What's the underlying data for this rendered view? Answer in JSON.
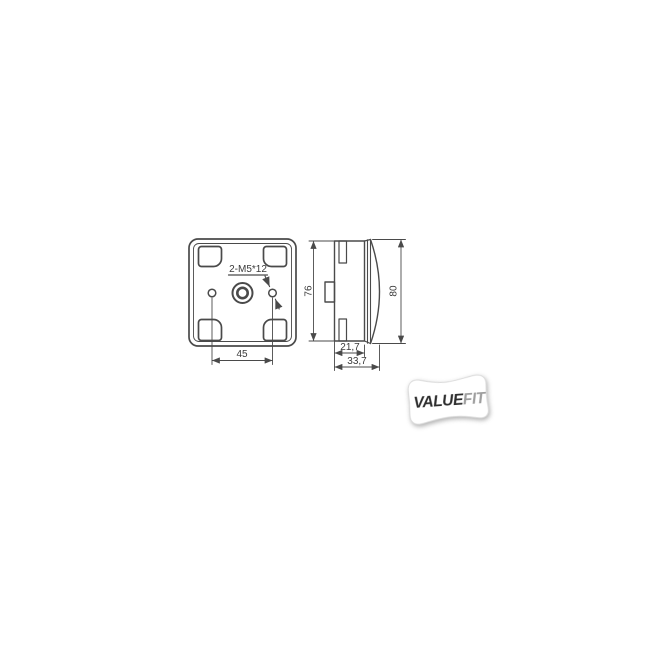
{
  "page": {
    "background": "#ffffff"
  },
  "drawing": {
    "line_color": "#4a4a4a",
    "text_color": "#3a3a3a",
    "front_view": {
      "screw_callout": "2-M5*12",
      "hole_spacing": "45"
    },
    "side_view": {
      "body_height": "76",
      "lens_height": "80",
      "body_depth": "21,7",
      "total_depth": "33,7"
    }
  },
  "badge": {
    "value_text": "VALUE",
    "fit_text": "FIT",
    "value_color": "#2d2d2d",
    "fit_color": "#9e9e9e",
    "background": "#ffffff"
  }
}
